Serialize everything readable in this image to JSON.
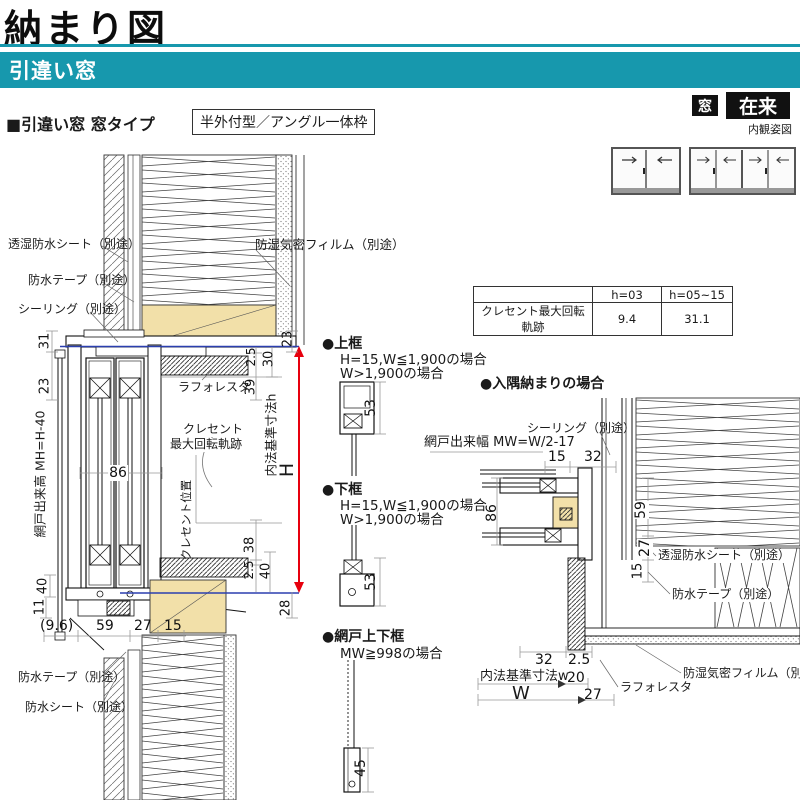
{
  "header": {
    "title": "納まり図",
    "banner": "引違い窓"
  },
  "badges": {
    "window": "窓",
    "method": "在来",
    "caption": "内観姿図"
  },
  "intro": {
    "heading": "■引違い窓 窓タイプ",
    "frame_type": "半外付型／アングル一体枠"
  },
  "table": {
    "col_headers": [
      "",
      "h=03",
      "h=05~15"
    ],
    "row_label": "クレセント最大回転軌跡",
    "values": [
      "9.4",
      "31.1"
    ]
  },
  "vertical_section": {
    "labels": {
      "toushitsu": "透湿防水シート（別途）",
      "bousui_tape": "防水テープ（別途）",
      "sealing": "シーリング（別途）",
      "boushitsu_film": "防湿気密フィルム（別途）",
      "laforesta": "ラフォレスタ",
      "crescent_line1": "クレセント",
      "crescent_line2": "最大回転軌跡",
      "crescent_pos": "クレセント位置",
      "amido_height": "網戸出来高 MH=H-40",
      "naiho_h": "内法基準寸法h",
      "H": "H",
      "bousui_tape_btm": "防水テープ（別途）",
      "bousui_sheet_btm": "防水シート（別途）"
    },
    "dims": {
      "d31": "31",
      "d23L": "23",
      "d86": "86",
      "d40L": "40",
      "d11": "11",
      "d96": "(9.6)",
      "d59": "59",
      "d27": "27",
      "d15": "15",
      "d23R": "23",
      "d25a": "2.5",
      "d30": "30",
      "d39": "39",
      "d38": "38",
      "d25b": "2.5",
      "d40R": "40",
      "d28": "28"
    }
  },
  "sub_details": {
    "uwagamachi": {
      "title": "●上框",
      "cond1": "H=15,W≦1,900の場合",
      "cond2": "W>1,900の場合",
      "dim": "53"
    },
    "shitagamachi": {
      "title": "●下框",
      "cond1": "H=15,W≦1,900の場合",
      "cond2": "W>1,900の場合",
      "dim": "53"
    },
    "amido_joge": {
      "title": "●網戸上下框",
      "cond1": "MW≧998の場合",
      "dim": "45"
    }
  },
  "corner_detail": {
    "title": "●入隅納まりの場合",
    "labels": {
      "sealing": "シーリング（別途）",
      "amido_width": "網戸出来幅 MW=W/2-17",
      "toushitsu": "透湿防水シート（別途）",
      "bousui_tape": "防水テープ（別途）",
      "boushitsu_film": "防湿気密フィルム（別途）",
      "laforesta": "ラフォレスタ",
      "naiho_w": "内法基準寸法w",
      "W": "W"
    },
    "dims": {
      "d15t": "15",
      "d32t": "32",
      "d86": "86",
      "d59": "59",
      "d27": "27",
      "d15m": "15",
      "d32b": "32",
      "d25": "2.5",
      "d20": "20",
      "d27b": "27"
    }
  },
  "colors": {
    "teal": "#1798ad",
    "tan": "#f2e0a9",
    "red": "#e7000e",
    "blue": "#2b3faf",
    "badge_black": "#111111"
  }
}
